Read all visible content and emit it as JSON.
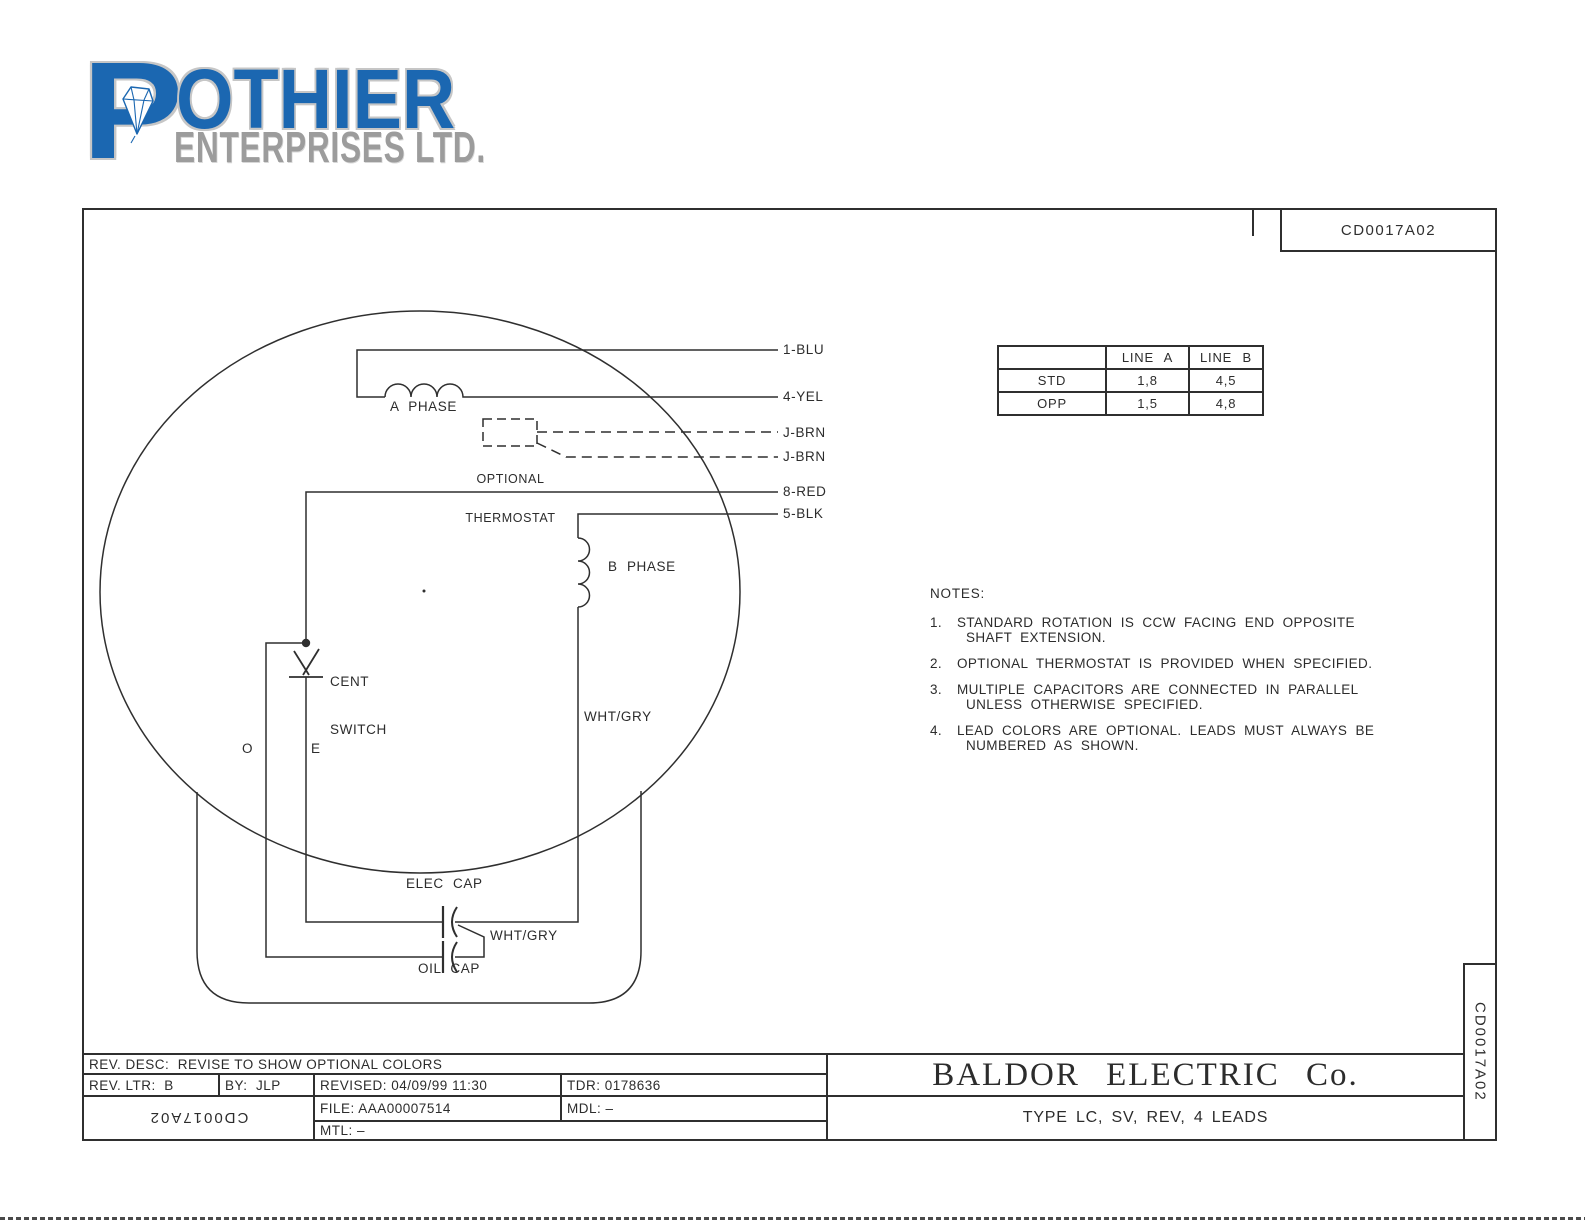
{
  "logo": {
    "p": "P",
    "rest": "OTHIER",
    "subtitle": "ENTERPRISES LTD."
  },
  "header": {
    "drawing_number": "CD0017A02"
  },
  "rotation_table": {
    "col_headers": [
      "LINE A",
      "LINE B"
    ],
    "rows": [
      {
        "label": "STD",
        "line_a": "1,8",
        "line_b": "4,5"
      },
      {
        "label": "OPP",
        "line_a": "1,5",
        "line_b": "4,8"
      }
    ]
  },
  "notes": {
    "title": "NOTES:",
    "items": [
      {
        "num": "1.",
        "line1": "STANDARD ROTATION IS CCW FACING END OPPOSITE",
        "line2": "SHAFT EXTENSION."
      },
      {
        "num": "2.",
        "line1": "OPTIONAL THERMOSTAT IS PROVIDED WHEN SPECIFIED.",
        "line2": ""
      },
      {
        "num": "3.",
        "line1": "MULTIPLE CAPACITORS ARE CONNECTED IN PARALLEL",
        "line2": "UNLESS OTHERWISE SPECIFIED."
      },
      {
        "num": "4.",
        "line1": "LEAD COLORS ARE OPTIONAL.  LEADS MUST ALWAYS BE",
        "line2": "NUMBERED AS SHOWN."
      }
    ]
  },
  "diagram": {
    "labels": {
      "a_phase": "A PHASE",
      "b_phase": "B PHASE",
      "optional_1": "OPTIONAL",
      "optional_2": "THERMOSTAT",
      "cent_1": "CENT",
      "cent_2": "SWITCH",
      "wht_gry_winding": "WHT/GRY",
      "wht_gry_cap": "WHT/GRY",
      "o": "O",
      "e": "E",
      "elec_cap": "ELEC CAP",
      "oil_cap": "OIL CAP"
    },
    "leads": [
      "1-BLU",
      "4-YEL",
      "J-BRN",
      "J-BRN",
      "8-RED",
      "5-BLK"
    ]
  },
  "title_block": {
    "rev_desc": "REV. DESC:  REVISE TO SHOW OPTIONAL COLORS",
    "rev_ltr": "REV. LTR:  B",
    "by": "BY:  JLP",
    "revised": "REVISED: 04/09/99 11:30",
    "tdr": "TDR: 0178636",
    "file": "FILE: AAA00007514",
    "mdl": "MDL: –",
    "mtl": "MTL: –",
    "drawing_number_flipped": "CD0017A02",
    "drawing_number_side": "CD0017A02",
    "company": "BALDOR ELECTRIC Co.",
    "type_line": "TYPE LC, SV, REV, 4 LEADS"
  },
  "colors": {
    "line": "#2f2f2f",
    "logo_blue": "#1b67b1",
    "logo_gray": "#9c9c9c",
    "outline_gray": "#c6c6c6"
  }
}
